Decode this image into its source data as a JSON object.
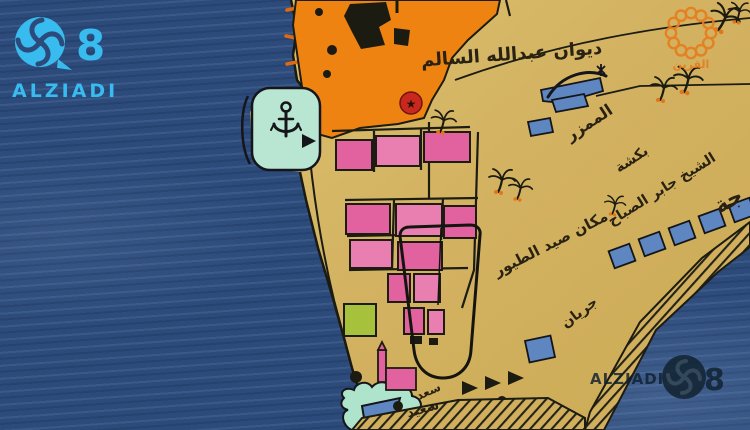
{
  "scene": {
    "description": "TV broadcast frame showing a vintage hand-drawn map of old Kuwait town on a peninsula surrounded by sea",
    "width": 750,
    "height": 430
  },
  "branding": {
    "top_left": {
      "eight": "8",
      "name": "ALZIADI",
      "color": "#38bbee"
    },
    "top_right": {
      "label": "القرين",
      "color": "#e67d1e"
    },
    "watermark": {
      "name": "ALZIADI",
      "eight": "8"
    }
  },
  "map": {
    "labels": {
      "diwan": "ديوان عبدالله السالم",
      "mamzar": "الممزر",
      "baksha_line1": "بكشة",
      "baksha_line2": "الشيخ جابر الصباح",
      "partial_word": "جة",
      "bird_hunting": "مكان صيد الطيور",
      "jiryan": "جريان",
      "saad": "سعد",
      "saeed": "سعيد"
    },
    "icons": {
      "anchor": "anchor-icon",
      "star_badge": "★",
      "palm": "palm-tree-icon",
      "boat": "dhow-boat-icon",
      "triangles": "coast-triangle-markers"
    },
    "colors": {
      "sea": "#2c4b7b",
      "land": "#d2b160",
      "town_orange": "#ef8312",
      "buildings_pink": "#e2619f",
      "harbor_mint": "#b8e6d2",
      "lagoon_teal": "#aee3cc",
      "field_green": "#a6c23c",
      "plots_blue": "#5e86c0",
      "badge_red": "#c8281e"
    }
  }
}
